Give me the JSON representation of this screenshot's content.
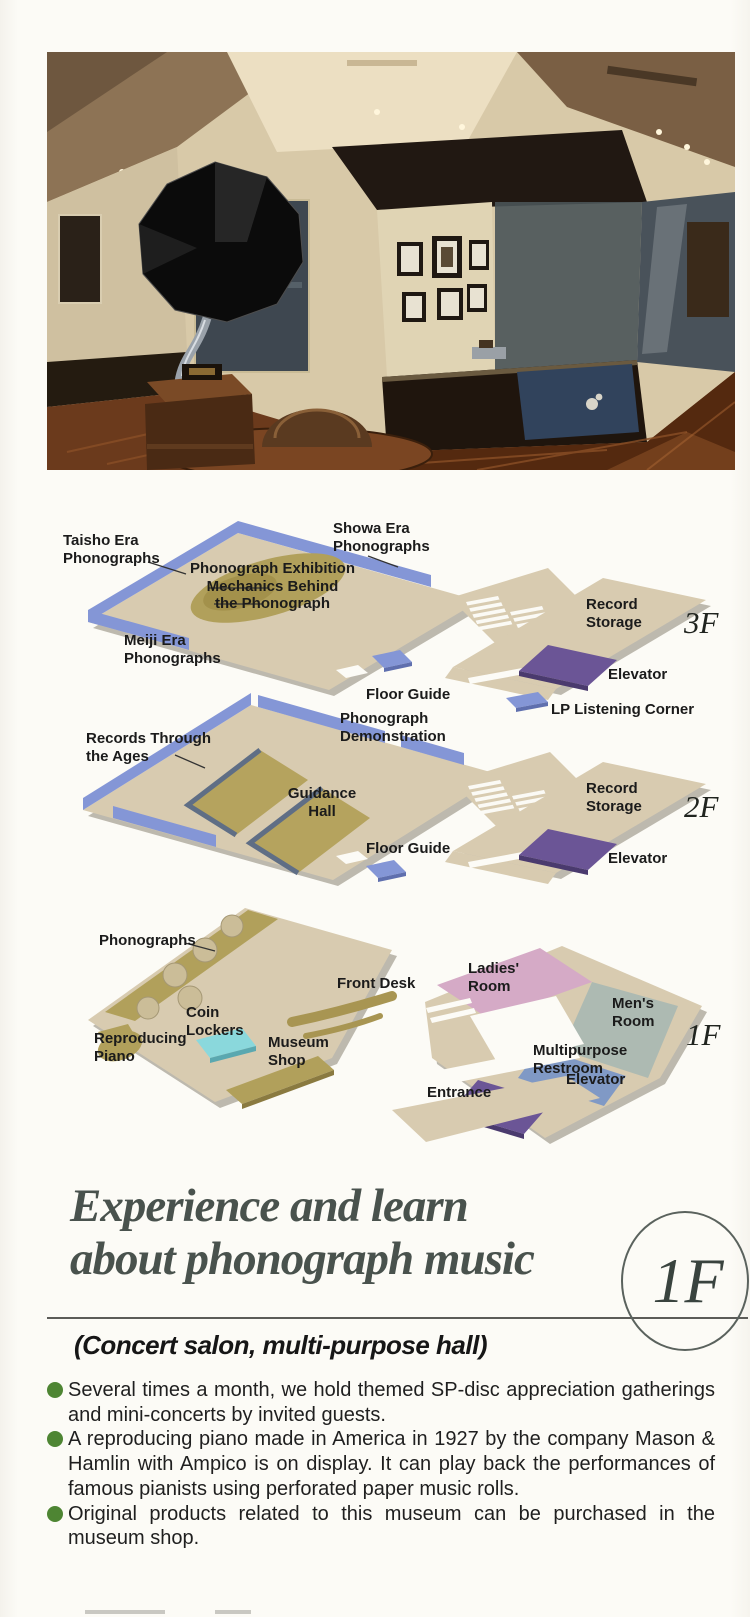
{
  "plans": {
    "f3": {
      "floor": "3F",
      "labels": {
        "taisho": "Taisho Era\nPhonographs",
        "showa": "Showa Era\nPhonographs",
        "exhibition": "Phonograph Exhibition\nMechanics Behind\nthe Phonograph",
        "meiji": "Meiji Era\nPhonographs",
        "record_storage": "Record\nStorage",
        "floor_guide": "Floor Guide",
        "elevator": "Elevator",
        "lp_corner": "LP Listening Corner"
      }
    },
    "f2": {
      "floor": "2F",
      "labels": {
        "records_ages": "Records Through\nthe Ages",
        "demonstration": "Phonograph\nDemonstration",
        "guidance_hall": "Guidance\nHall",
        "record_storage": "Record\nStorage",
        "floor_guide": "Floor Guide",
        "elevator": "Elevator"
      }
    },
    "f1": {
      "floor": "1F",
      "labels": {
        "phonographs": "Phonographs",
        "ladies": "Ladies'\nRoom",
        "mens": "Men's\nRoom",
        "front_desk": "Front Desk",
        "coin_lockers": "Coin\nLockers",
        "multipurpose": "Multipurpose\nRestroom",
        "reproducing_piano": "Reproducing\nPiano",
        "museum_shop": "Museum\nShop",
        "elevator": "Elevator",
        "entrance": "Entrance"
      }
    }
  },
  "heading": {
    "line1": "Experience and learn",
    "line2": "about phonograph music",
    "floor_badge": "1F"
  },
  "subtitle": "(Concert salon, multi-purpose hall)",
  "bullets": [
    "Several times a month, we hold themed SP-disc appreciation gatherings and mini-concerts by invited guests.",
    "A reproducing piano made in America in 1927 by the company Mason & Hamlin with Ampico is on display.  It can play back the performances of famous pianists using perforated paper music rolls.",
    "Original products related to this museum can be purchased in the museum shop."
  ],
  "colors": {
    "wall_blue": "#8496d6",
    "floor_tan": "#d8cbb0",
    "elevator_purple": "#6b5596",
    "locker_cyan": "#8ad8dc",
    "ladies_pink": "#d5aac6",
    "mens_gray": "#adbab2",
    "restroom_blue": "#8099c5",
    "exhibit_olive": "#b1a05b",
    "bullet_green": "#4e8533",
    "heading_gray_green": "#49524d"
  }
}
